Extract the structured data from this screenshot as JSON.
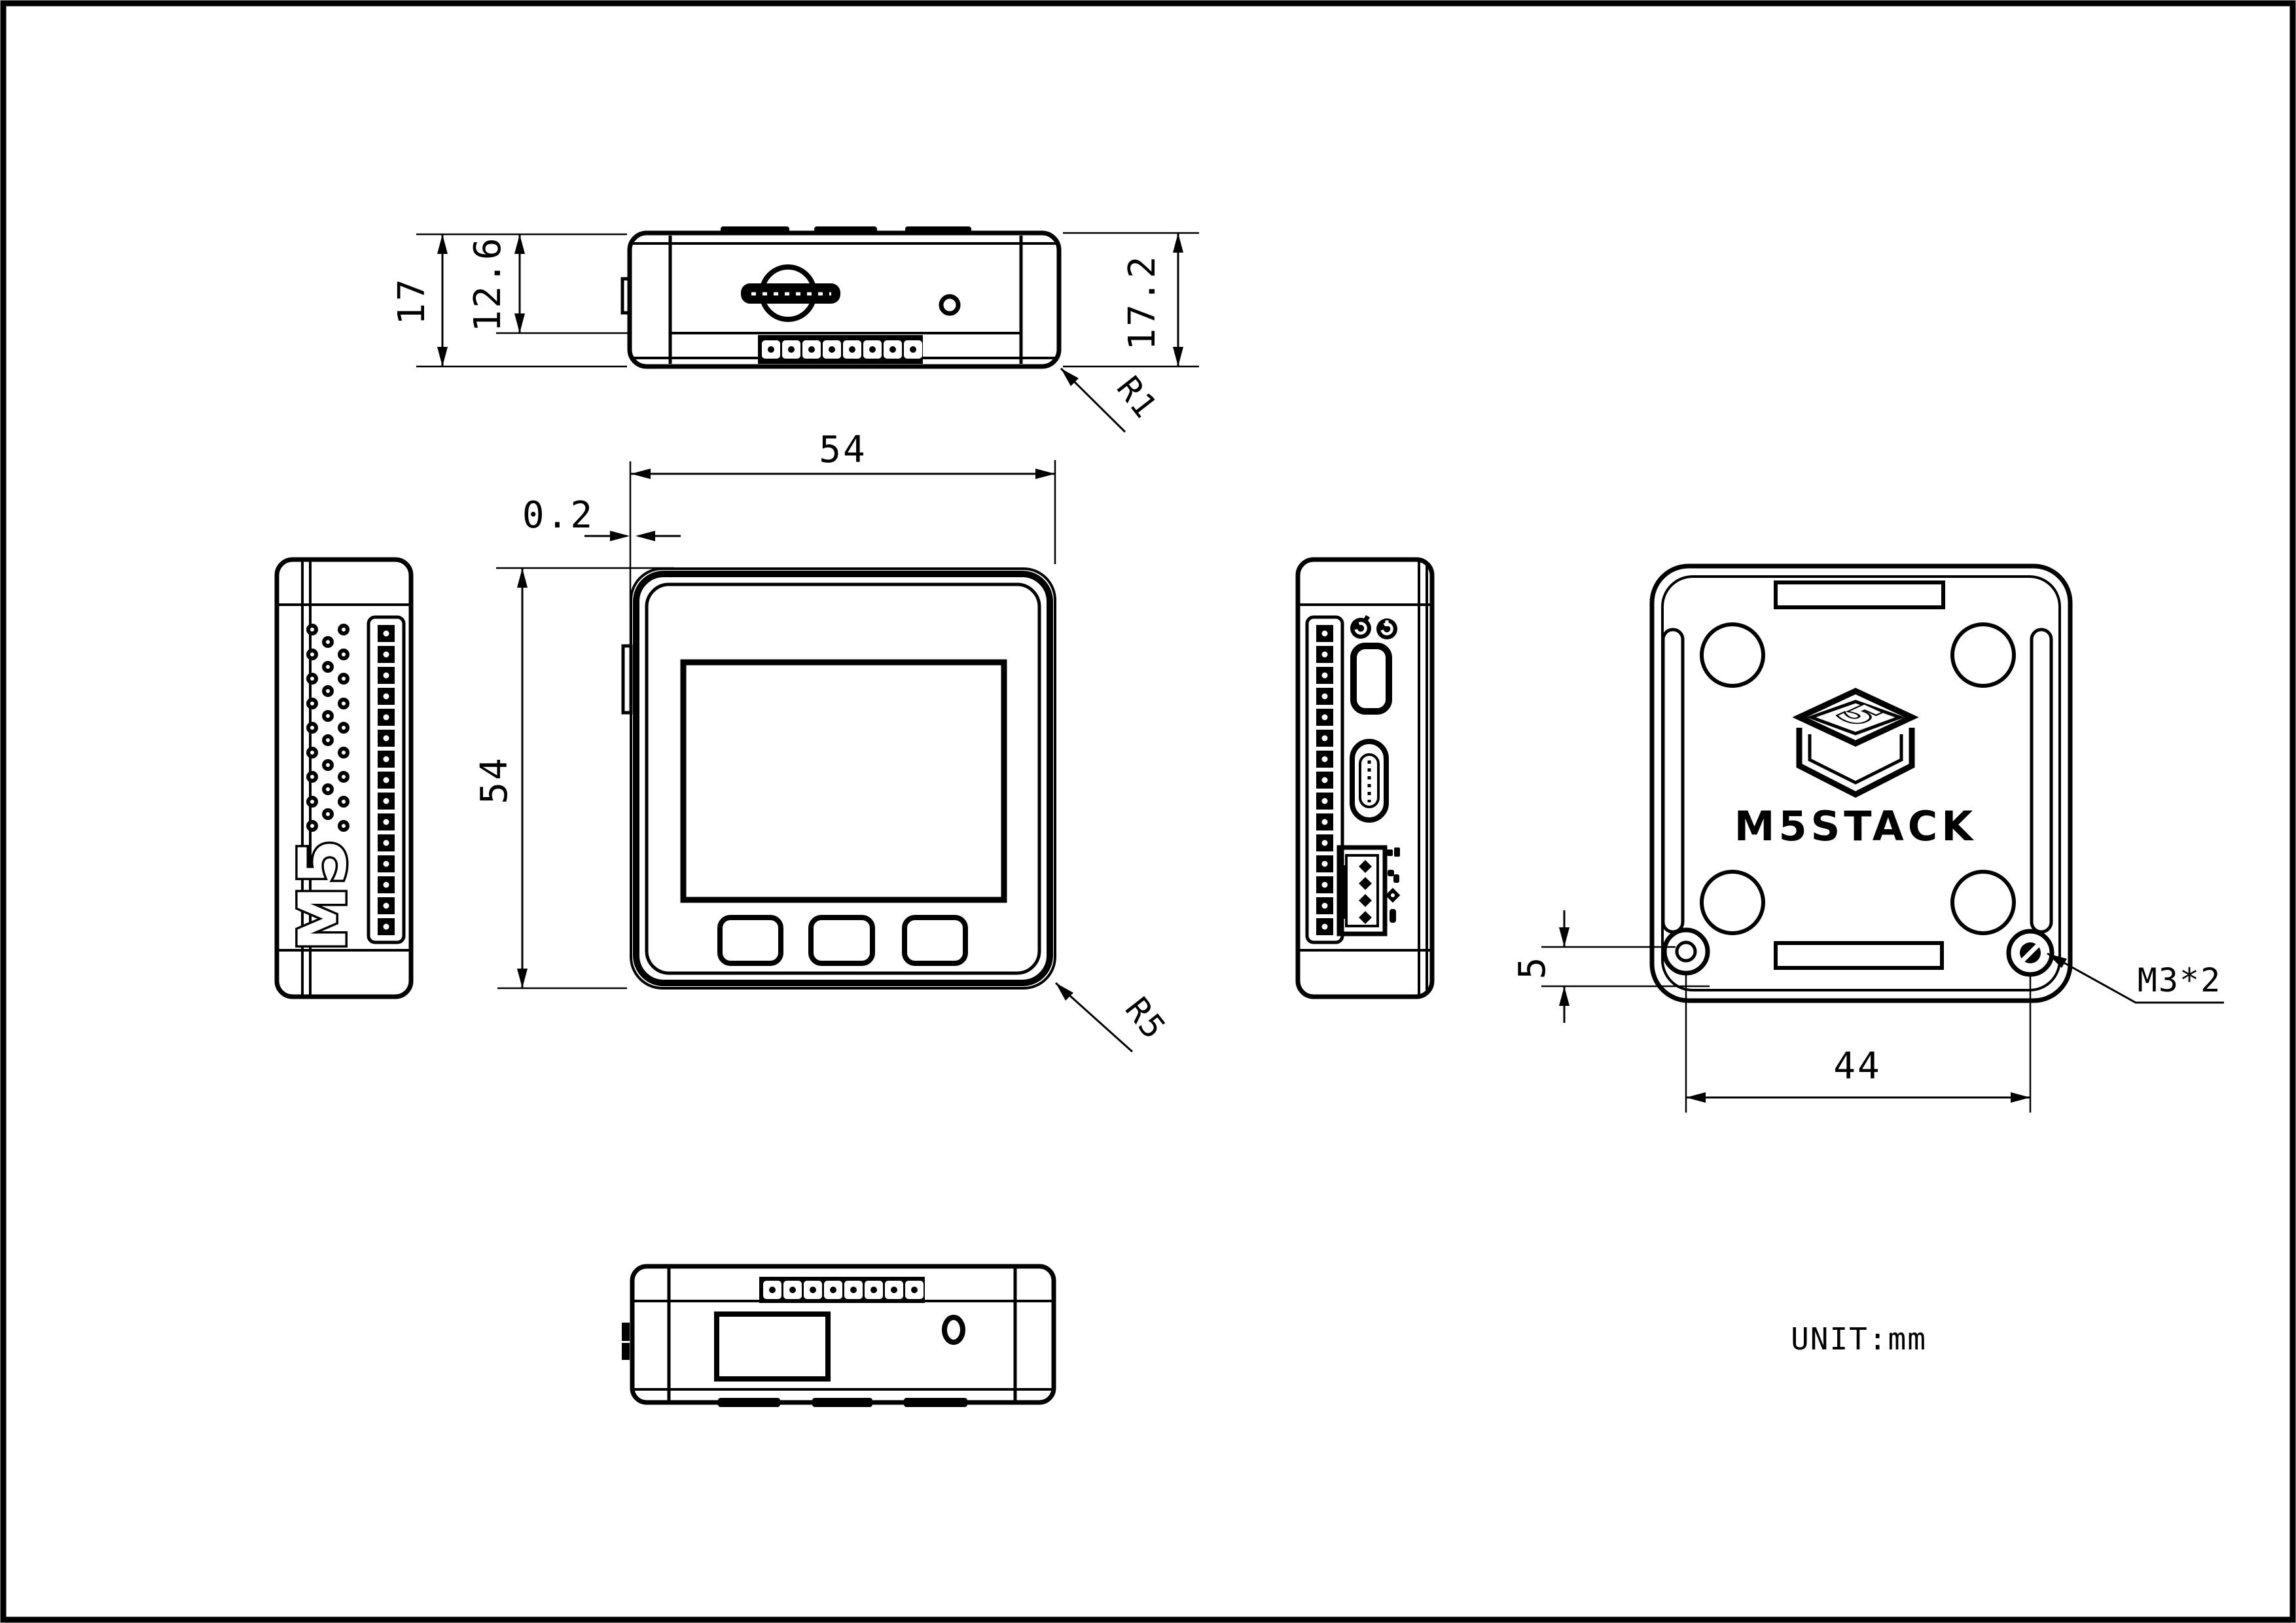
{
  "sheet": {
    "background": "#ffffff",
    "line_color": "#000000",
    "unit_note": "UNIT:mm"
  },
  "top_view": {
    "dim_overall_height": "17",
    "dim_lid_height": "12.6",
    "dim_total_height": "17.2",
    "corner_radius_note": "R1"
  },
  "front_view": {
    "dim_width": "54",
    "dim_height": "54",
    "dim_lid_step": "0.2",
    "corner_radius_note": "R5"
  },
  "left_side_view": {
    "logo_text": "M5"
  },
  "back_view": {
    "brand_text": "M5STACK",
    "cube_glyph": "5",
    "dim_screw_offset": "5",
    "dim_screw_spacing": "44",
    "screw_spec_note": "M3*2"
  }
}
